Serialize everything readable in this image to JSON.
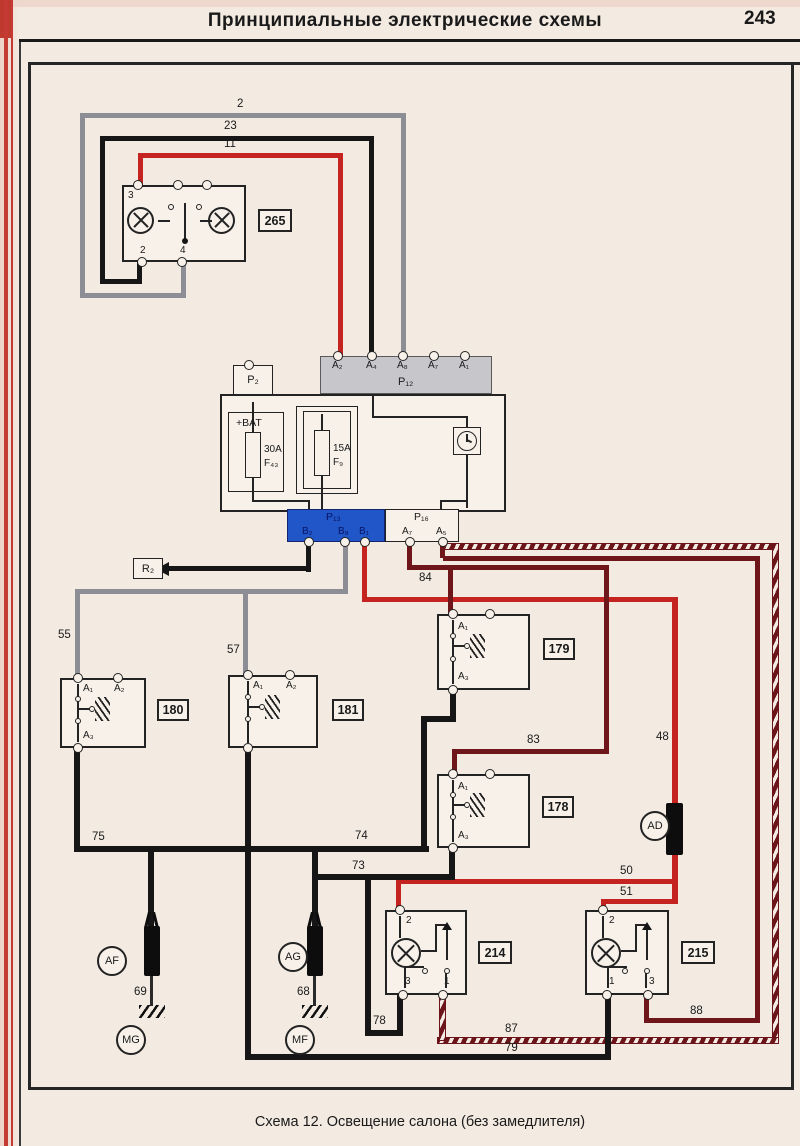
{
  "page": {
    "title": "Принципиальные электрические схемы",
    "page_number": "243",
    "caption": "Схема 12. Освещение салона (без замедлителя)"
  },
  "colors": {
    "wire_red": "#c4231f",
    "wire_dark_red": "#6e161a",
    "wire_gray": "#8d8d96",
    "wire_black": "#161616",
    "wire_striped": "#6b151a on white",
    "connector_blue": "#2056c8",
    "connector_gray": "#c6c6cb",
    "margin_red": "#c0392f",
    "page_bg": "#f3ebe2"
  },
  "components": {
    "unit265": {
      "ref": "265",
      "pin3": "3",
      "pin2": "2",
      "pin4": "4"
    },
    "connP2": {
      "label": "P₂"
    },
    "connP12": {
      "label": "P₁₂",
      "pins": [
        "A₂",
        "A₄",
        "A₈",
        "A₇",
        "A₁"
      ]
    },
    "fuseF43": {
      "bat": "+BAT",
      "rating": "30A",
      "name": "F₄₃"
    },
    "fuseF9": {
      "rating": "15A",
      "name": "F₉"
    },
    "connP13": {
      "label": "P₁₃",
      "pins": [
        "B₂",
        "B₈",
        "B₁"
      ]
    },
    "connP16": {
      "label": "P₁₆",
      "pins": [
        "A₇",
        "A₅"
      ]
    },
    "connR2": {
      "label": "R₂"
    },
    "sw180": {
      "ref": "180",
      "a1": "A₁",
      "a2": "A₂",
      "a3": "A₃"
    },
    "sw181": {
      "ref": "181",
      "a1": "A₁",
      "a2": "A₂"
    },
    "sw179": {
      "ref": "179",
      "a1": "A₁",
      "a3": "A₃"
    },
    "sw178": {
      "ref": "178",
      "a1": "A₁",
      "a3": "A₃"
    },
    "lamp214": {
      "ref": "214",
      "pin_top": "2",
      "pin_bl": "3",
      "pin_br": "1"
    },
    "lamp215": {
      "ref": "215",
      "pin_top": "2",
      "pin_bl": "1",
      "pin_br": "3"
    },
    "spliceAF": {
      "label": "AF"
    },
    "spliceAG": {
      "label": "AG"
    },
    "spliceAD": {
      "label": "AD"
    },
    "groundMG": {
      "label": "MG"
    },
    "groundMF": {
      "label": "MF"
    }
  },
  "wires": {
    "w2": "2",
    "w23": "23",
    "w11": "11",
    "w55": "55",
    "w57": "57",
    "w84": "84",
    "w83": "83",
    "w48": "48",
    "w75": "75",
    "w74": "74",
    "w73": "73",
    "w50": "50",
    "w51": "51",
    "w69": "69",
    "w68": "68",
    "w78": "78",
    "w87": "87",
    "w79": "79",
    "w88": "88"
  }
}
